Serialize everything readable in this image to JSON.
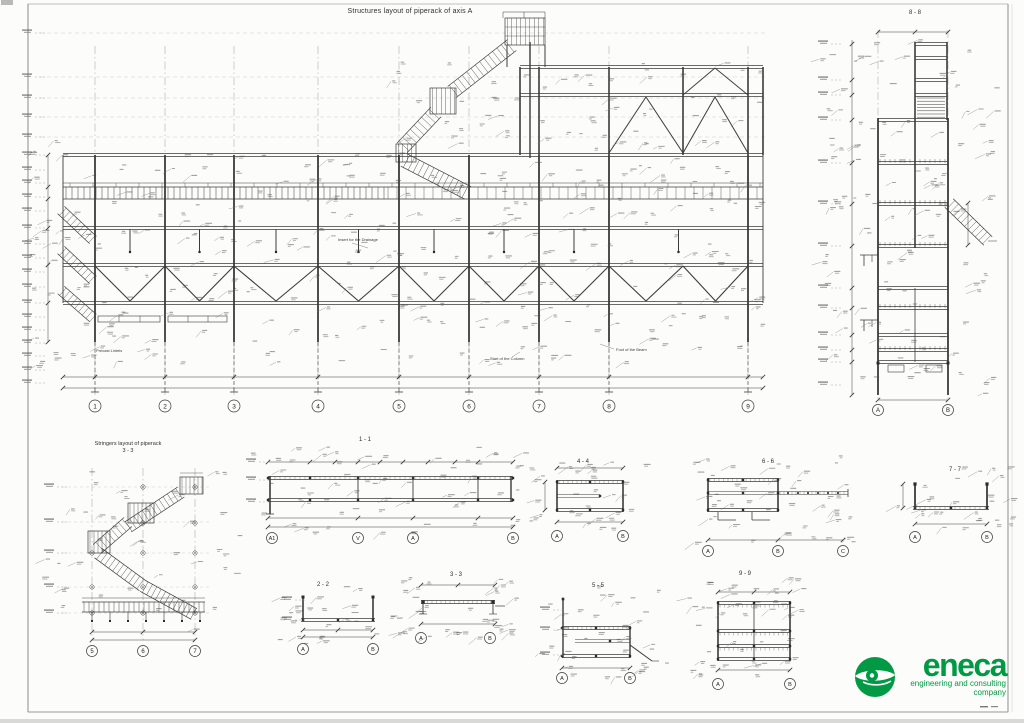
{
  "sheet": {
    "title": "Structures layout of piperack  of axis A",
    "colors": {
      "ink": "#3b3b3b",
      "light": "#9f9f9f",
      "faint": "#c9c9c9",
      "paper": "#fcfcfa",
      "green": "#009a44"
    }
  },
  "main_plan": {
    "grid_bubbles": [
      "1",
      "2",
      "3",
      "4",
      "5",
      "6",
      "7",
      "8",
      "9"
    ],
    "callouts": {
      "precast": "Precast Lintels",
      "drainage": "Insert for the Drainage",
      "column_start": "Start of the Column",
      "beam_foot": "Foot of the Beam"
    }
  },
  "tower_section": {
    "title": "8 - 8",
    "grid_bubbles": [
      "A",
      "B"
    ]
  },
  "stringers_plan": {
    "title_line1": "Stringers layout of piperack",
    "title_line2": "3 - 3",
    "grid_bubbles": [
      "5",
      "6",
      "7"
    ]
  },
  "sections": {
    "s11": {
      "title": "1 - 1",
      "bubbles": [
        "A1",
        "V",
        "A",
        "B"
      ]
    },
    "s22": {
      "title": "2 - 2",
      "bubbles": [
        "A",
        "B"
      ]
    },
    "s33": {
      "title": "3 - 3",
      "bubbles": [
        "A",
        "B"
      ]
    },
    "s44": {
      "title": "4 - 4",
      "bubbles": [
        "A",
        "B"
      ]
    },
    "s55": {
      "title": "5 - 5",
      "bubbles": [
        "A",
        "B"
      ]
    },
    "s66": {
      "title": "6 - 6",
      "bubbles": [
        "A",
        "B",
        "C"
      ]
    },
    "s77": {
      "title": "7 - 7",
      "bubbles": [
        "A",
        "B"
      ]
    },
    "s99": {
      "title": "9 - 9",
      "bubbles": [
        "A",
        "B"
      ]
    }
  },
  "logo": {
    "name": "eneca",
    "tagline1": "engineering and consulting",
    "tagline2": "company"
  }
}
